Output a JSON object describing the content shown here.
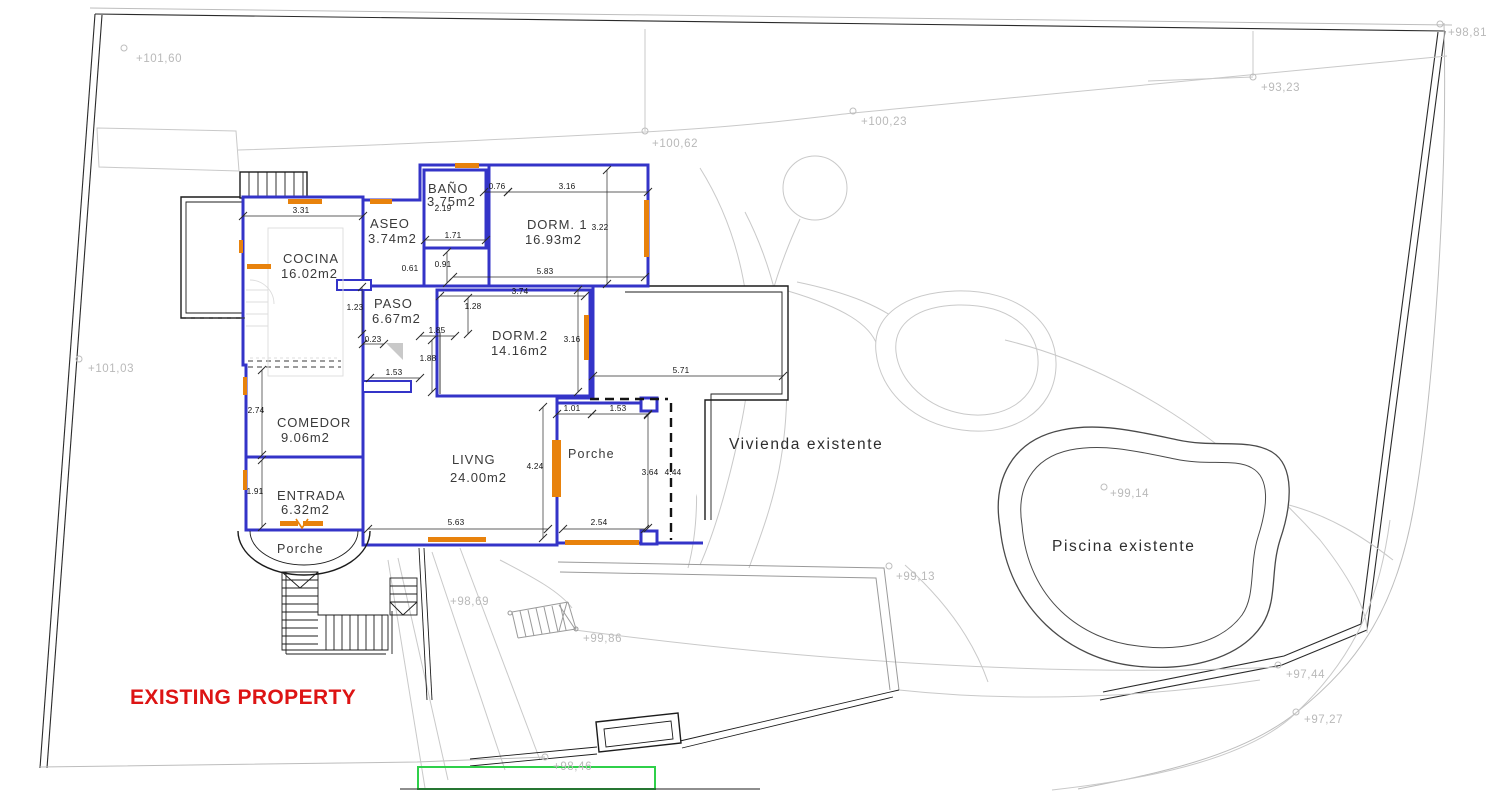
{
  "drawing_type": "site-plan-floor-plan",
  "labels": {
    "vivienda": "Vivienda existente",
    "piscina": "Piscina existente",
    "porche_front": "Porche",
    "porche_side": "Porche",
    "annotation": "EXISTING PROPERTY"
  },
  "rooms": {
    "cocina": {
      "name": "COCINA",
      "area": "16.02m2"
    },
    "aseo": {
      "name": "ASEO",
      "area": "3.74m2"
    },
    "bano": {
      "name": "BAÑO",
      "area": "3.75m2"
    },
    "dorm1": {
      "name": "DORM. 1",
      "area": "16.93m2"
    },
    "paso": {
      "name": "PASO",
      "area": "6.67m2"
    },
    "dorm2": {
      "name": "DORM.2",
      "area": "14.16m2"
    },
    "comedor": {
      "name": "COMEDOR",
      "area": "9.06m2"
    },
    "entrada": {
      "name": "ENTRADA",
      "area": "6.32m2"
    },
    "livng": {
      "name": "LIVNG",
      "area": "24.00m2"
    }
  },
  "dims": {
    "w331": "3.31",
    "w076": "0.76",
    "w316a": "3.16",
    "h219": "2.19",
    "h322": "3.22",
    "w171": "1.71",
    "h091": "0.91",
    "w061": "0.61",
    "w583": "5.83",
    "w374": "3.74",
    "h128": "1.28",
    "h123": "1.23",
    "w185": "1.85",
    "h188": "1.88",
    "h316b": "3.16",
    "w023": "0.23",
    "w153a": "1.53",
    "w571": "5.71",
    "w101": "1.01",
    "w153b": "1.53",
    "h274": "2.74",
    "h424": "4.24",
    "h364": "3.64",
    "h444": "4.44",
    "h191": "1.91",
    "w563": "5.63",
    "w254": "2.54"
  },
  "elevations": {
    "p10160": "+101,60",
    "p9881": "+98,81",
    "p9323": "+93,23",
    "p10062": "+100,62",
    "p10023": "+100,23",
    "p10103": "+101,03",
    "p9914": "+99,14",
    "p9913": "+99,13",
    "p9869": "+98,69",
    "p9986": "+99,86",
    "p9744": "+97,44",
    "p9727": "+97,27",
    "p9846": "+98,46"
  },
  "colors": {
    "wall_blue": "#3434c8",
    "window_orange": "#e8820c",
    "annotation_red": "#dd1414",
    "boundary_green": "#2fd04a",
    "terrain_gray": "#c9c9c9",
    "elevation_gray": "#b9b9b9"
  }
}
